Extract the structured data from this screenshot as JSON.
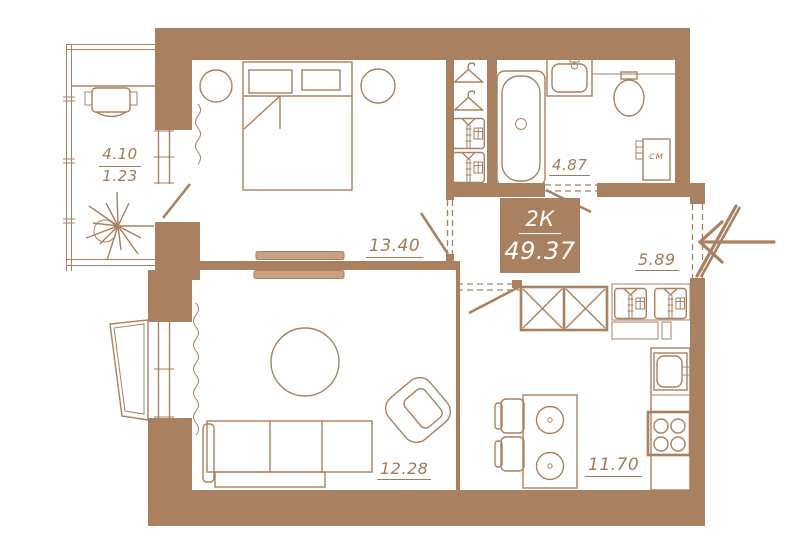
{
  "plan": {
    "unit": {
      "type": "2К",
      "total_area": "49.37"
    },
    "rooms": {
      "balcony": {
        "area": "4.10",
        "area_reduced": "1.23"
      },
      "bedroom": {
        "area": "13.40"
      },
      "bathroom": {
        "area": "4.87"
      },
      "hallway": {
        "area": "5.89"
      },
      "living_room": {
        "area": "12.28"
      },
      "kitchen": {
        "area": "11.70"
      }
    },
    "appliances": {
      "washing_machine": "см"
    }
  },
  "icons": {
    "plant-icon": "starburst plant on balcony",
    "hanger-icon": "clothes hanger",
    "shirt-icon": "folded shirt",
    "bathtub-icon": "bathtub",
    "sink-icon": "washbasin",
    "toilet-icon": "toilet bowl",
    "stove-icon": "4-burner cooktop",
    "entrance-arrow-icon": "entry direction arrow",
    "sliding-door-icon": "sliding door panels",
    "rug-icon": "round rug"
  },
  "colors": {
    "wall": "#a98160",
    "line": "#a98160",
    "label_text": "#a27a58",
    "unit_label_bg": "#a98160",
    "unit_label_text": "#ffffff",
    "door_panel_fill": "#c9a284",
    "background": "#ffffff"
  }
}
